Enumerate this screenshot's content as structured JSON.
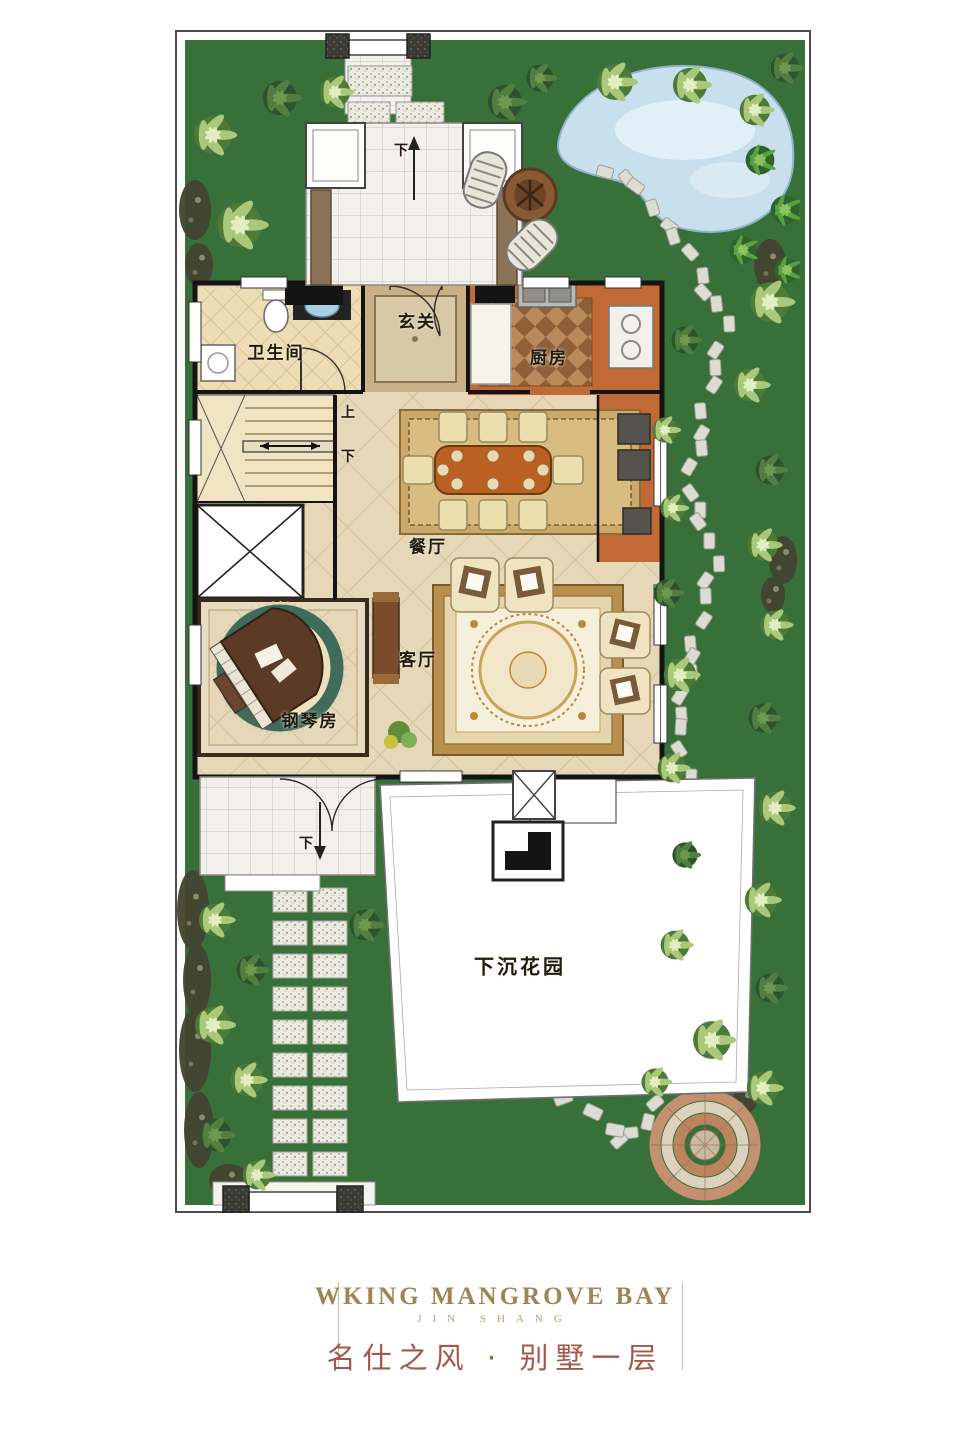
{
  "plan": {
    "labels": {
      "foyer": "玄关",
      "bathroom": "卫生间",
      "kitchen": "厨房",
      "dining": "餐厅",
      "living": "客厅",
      "piano_room": "钢琴房",
      "sunken_garden": "下沉花园",
      "stairs_up": "上",
      "stairs_down": "下",
      "porch_down": "下",
      "terrace_down": "下"
    }
  },
  "footer": {
    "brand_en": "WKING MANGROVE BAY",
    "brand_sub": "JIN SHANG",
    "title_cn": "名仕之风 · 别墅一层"
  },
  "colors": {
    "grass": "#38703a",
    "floor_beige": "#e5d7b8",
    "kitchen_floor": "#c16a35",
    "wall": "#141414",
    "pond": "#c8e0ee",
    "accent_gold": "#a08554",
    "accent_red": "#a4584a"
  }
}
